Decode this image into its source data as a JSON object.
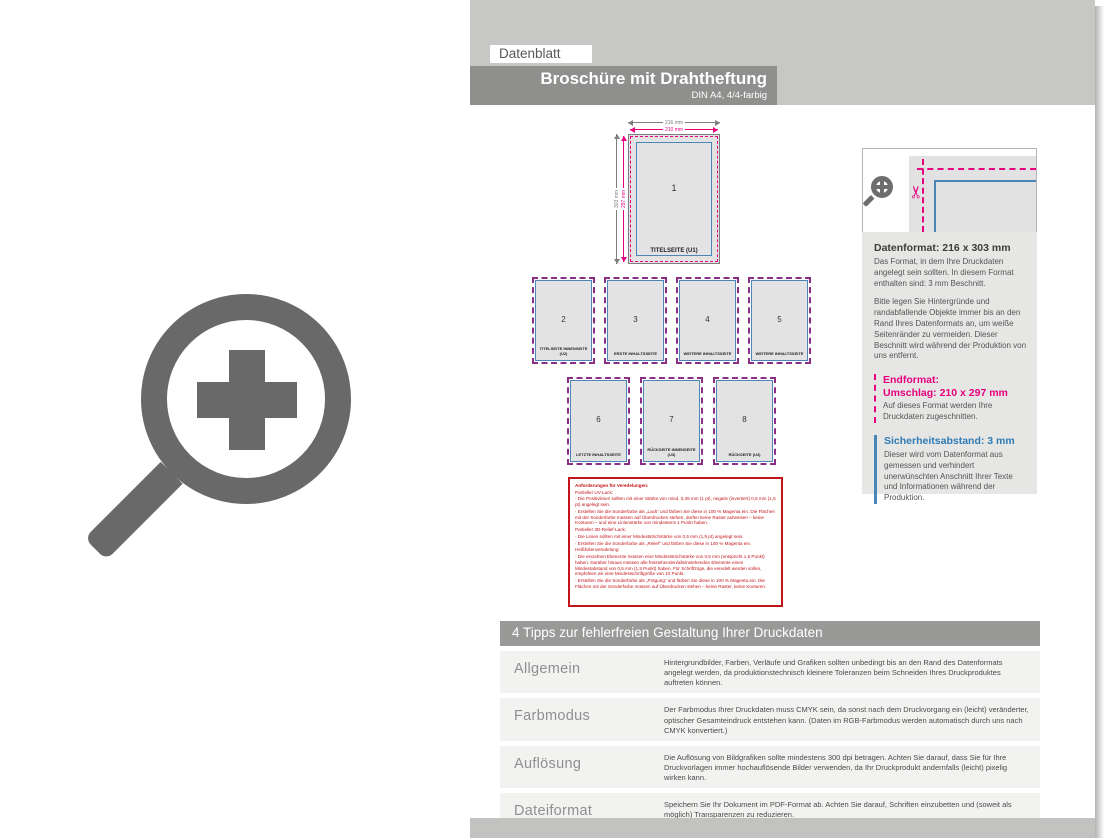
{
  "header": {
    "tab": "Datenblatt",
    "title": "Broschüre mit Drahtheftung",
    "subtitle": "DIN A4, 4/4-farbig"
  },
  "diagram": {
    "dim_top_outer": "216 mm",
    "dim_top_inner": "210 mm",
    "dim_left_outer": "303 mm",
    "dim_left_inner": "297 mm",
    "pages": [
      {
        "num": "1",
        "label": "TITELSEITE (U1)"
      },
      {
        "num": "2",
        "label": "TITELSEITE INNENSEITE (U2)"
      },
      {
        "num": "3",
        "label": "ERSTE INHALTSSEITE"
      },
      {
        "num": "4",
        "label": "WEITERE INHALTSSEITE"
      },
      {
        "num": "5",
        "label": "WEITERE INHALTSSEITE"
      },
      {
        "num": "6",
        "label": "LETZTE INHALTSSEITE"
      },
      {
        "num": "7",
        "label": "RÜCKSEITE INNENSEITE (U3)"
      },
      {
        "num": "8",
        "label": "RÜCKSEITE (U4)"
      }
    ]
  },
  "info_panel": {
    "datenformat_title": "Datenformat: 216 x 303 mm",
    "datenformat_p1": "Das Format, in dem Ihre Druckdaten angelegt sein sollten. In diesem Format enthalten sind: 3 mm Beschnitt.",
    "datenformat_p2": "Bitte legen Sie Hintergründe und randabfallende Objekte immer bis an den Rand Ihres Datenformats an, um weiße Seitenränder zu vermeiden. Dieser Beschnitt wird während der Produktion von uns entfernt.",
    "endformat_title": "Endformat:",
    "endformat_value": "Umschlag: 210 x 297 mm",
    "endformat_p": "Auf dieses Format werden Ihre Druckdaten zugeschnitten.",
    "sicherheit_title": "Sicherheitsabstand: 3 mm",
    "sicherheit_p": "Dieser wird vom Datenformat aus gemessen und verhindert unerwünschten Anschnitt Ihrer Texte und Informationen während der Produktion."
  },
  "veredelung_box": {
    "title": "Anforderungen für Veredelungen:",
    "lines": [
      "Partieller UV-Lack:",
      "· Die Positivlinien sollten mit einer Stärke von mind. 0,35 mm (1 pt), negativ (invertiert) 0,5 mm (1,5 pt) angelegt sein.",
      "· Erstellen Sie die Sonderfarbe als „Lack“ und färben Sie diese in 100 % Magenta ein. Die Flächen mit der Sonderfarbe müssen auf Überdrucken stehen, dürfen keine Raster aufweisen – keine Konturen – und eine Linienstärke von mindestens 1 Punkt haben.",
      "Partieller 3D-Relief-Lack:",
      "· Die Linien sollten mit einer Mindeststrichstärke von 0,5 mm (1,5 pt) angelegt sein.",
      "· Erstellen Sie die Sonderfarbe als „Relief“ und färben Sie diese in 100 % Magenta ein.",
      "Heißfolienveredelung:",
      "· Die einzelnen Elemente müssen eine Mindeststrichstärke von 0,5 mm (entspricht 1,5 Punkt) haben. Darüber hinaus müssen alle freistehenden/alleinstehenden Elemente einen Mindestabstand von 0,5 mm (1,5 Punkt) haben. Für Schriftzüge, die veredelt werden sollen, empfehlen wir eine Mindestschriftgröße von 10 Punkt.",
      "· Erstellen Sie die Sonderfarbe als „Prägung“ und färben Sie diese in 100 % Magenta ein. Die Flächen mit der Sonderfarbe müssen auf Überdrucken stehen – keine Raster, keine Konturen."
    ]
  },
  "tips": {
    "header": "4 Tipps zur fehlerfreien Gestaltung Ihrer Druckdaten",
    "rows": [
      {
        "label": "Allgemein",
        "text": "Hintergrundbilder, Farben, Verläufe und Grafiken sollten unbedingt bis an den Rand des Datenformats angelegt werden, da produktionstechnisch kleinere Toleranzen beim Schneiden Ihres Druckproduktes auftreten können."
      },
      {
        "label": "Farbmodus",
        "text": "Der Farbmodus Ihrer Druckdaten muss CMYK sein, da sonst nach dem Druckvorgang ein (leicht) veränderter, optischer Gesamteindruck entstehen kann. (Daten im RGB-Farbmodus werden automatisch durch uns nach CMYK konvertiert.)"
      },
      {
        "label": "Auflösung",
        "text": "Die Auflösung von Bildgrafiken sollte mindestens 300 dpi betragen. Achten Sie darauf, dass Sie für Ihre Druckvorlagen immer hochauflösende Bilder verwenden, da Ihr Druckprodukt andernfalls (leicht) pixelig wirken kann."
      },
      {
        "label": "Dateiformat",
        "text": "Speichern Sie Ihr Dokument im PDF-Format ab. Achten Sie darauf, Schriften einzubetten und (soweit als möglich) Transparenzen zu reduzieren."
      }
    ]
  },
  "icons": {
    "zoom_large": "zoom-plus-icon",
    "zoom_small": "zoom-plus-icon",
    "scissors": "✂"
  },
  "colors": {
    "magenta": "#e6007e",
    "blue": "#4a86b8",
    "red": "#c2151b",
    "title_band_gray": "#8f8f8e",
    "light_gray_band": "#c7c7c6",
    "icon_gray": "#696969"
  }
}
